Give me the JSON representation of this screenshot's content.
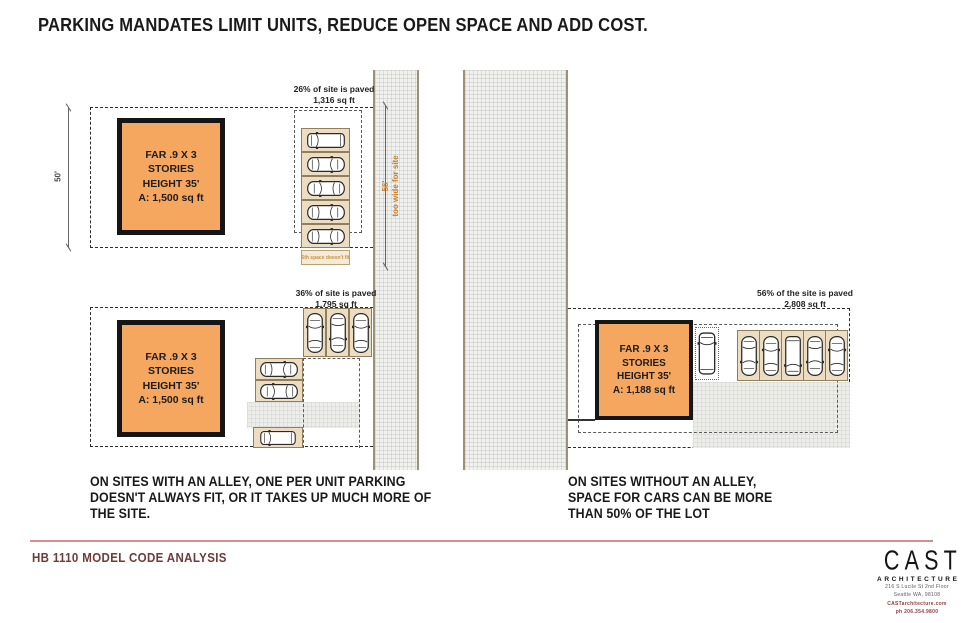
{
  "title": "PARKING MANDATES LIMIT UNITS, REDUCE OPEN SPACE AND ADD COST.",
  "site1": {
    "paved_pct": "26% of site is paved",
    "paved_area": "1,316 sq ft",
    "height_dim": "50'",
    "building": {
      "line1": "FAR .9 X 3 STORIES",
      "line2": "HEIGHT 35'",
      "line3": "A: 1,500 sq ft"
    },
    "street_dim": "56'",
    "street_note": "too wide for site",
    "stall_note": "6th space doesn't fit"
  },
  "site2": {
    "paved_pct": "36% of site is paved",
    "paved_area": "1,795 sq ft",
    "building": {
      "line1": "FAR .9 X 3 STORIES",
      "line2": "HEIGHT 35'",
      "line3": "A: 1,500 sq ft"
    }
  },
  "site3": {
    "paved_pct": "56% of the site is paved",
    "paved_area": "2,808 sq ft",
    "building": {
      "line1": "FAR .9 X 3 STORIES",
      "line2": "HEIGHT 35'",
      "line3": "A: 1,188 sq ft"
    }
  },
  "captions": {
    "left": [
      "ON SITES WITH AN ALLEY, ONE PER UNIT PARKING",
      "DOESN'T ALWAYS FIT, OR IT TAKES UP MUCH MORE OF",
      "THE SITE."
    ],
    "right": [
      "ON SITES WITHOUT AN ALLEY,",
      "SPACE FOR CARS CAN BE MORE",
      "THAN 50% OF THE LOT"
    ]
  },
  "footer": {
    "label": "HB 1110 MODEL CODE ANALYSIS"
  },
  "logo": {
    "name": "CAST",
    "tagline": "ARCHITECTURE",
    "address1": "216 S Lucile St 2nd Floor",
    "address2": "Seattle WA, 98108",
    "website": "CASTarchitecture.com",
    "phone": "ph 206.354.9800"
  },
  "colors": {
    "building_fill": "#F5A65F",
    "stall_fill": "#EBDCC2",
    "street_fill": "#F1F1EF",
    "accent_orange": "#CE7F2E",
    "footer_text": "#6E3B3B",
    "divider_pink": "#D48F8F"
  }
}
